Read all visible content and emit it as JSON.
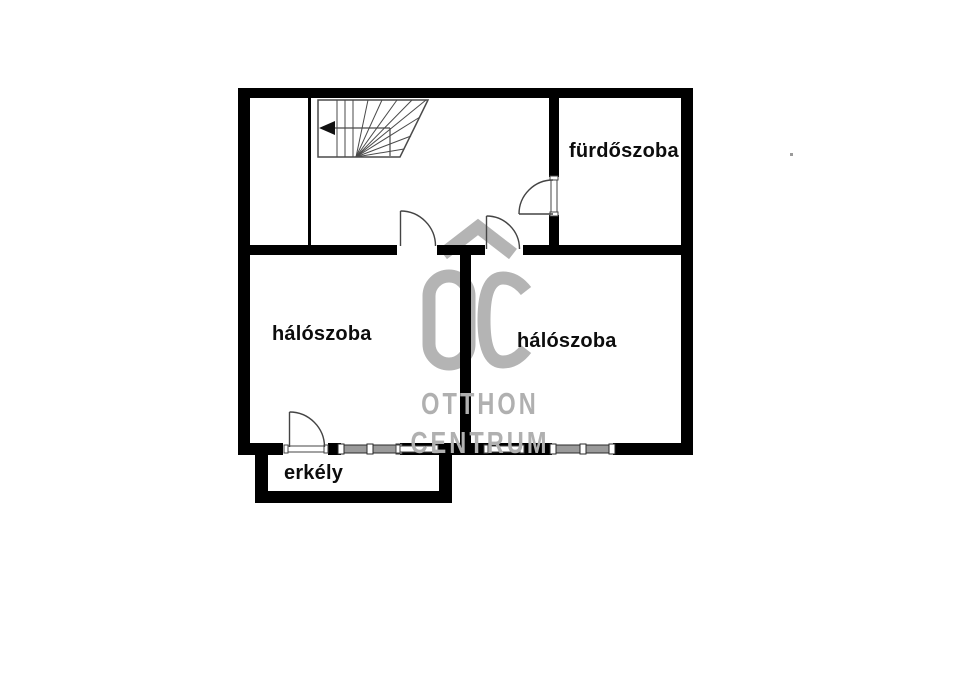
{
  "document": {
    "type": "floor-plan",
    "background_color": "#ffffff"
  },
  "floorplan": {
    "rooms": [
      {
        "id": "bathroom",
        "label": "fürdőszoba"
      },
      {
        "id": "bedroom-left",
        "label": "hálószoba"
      },
      {
        "id": "bedroom-right",
        "label": "hálószoba"
      },
      {
        "id": "balcony",
        "label": "erkély"
      }
    ],
    "features": {
      "staircase": "winder stairs with left-pointing direction arrow, top-left of plan",
      "doors": [
        "bathroom-door",
        "bedroom-left-door",
        "bedroom-right-door",
        "balcony-door"
      ],
      "windows": [
        "bedroom-left-window",
        "bedroom-right-window"
      ]
    },
    "colors": {
      "wall": "#000000",
      "label_text": "#0d0d0d",
      "door_window_line": "#444444",
      "window_glass_fill": "#9a9a9a",
      "watermark_gray": "#b0b0b0"
    }
  },
  "watermark": {
    "logo_text": "OC",
    "line1": "OTTHON",
    "line2": "CENTRUM"
  }
}
